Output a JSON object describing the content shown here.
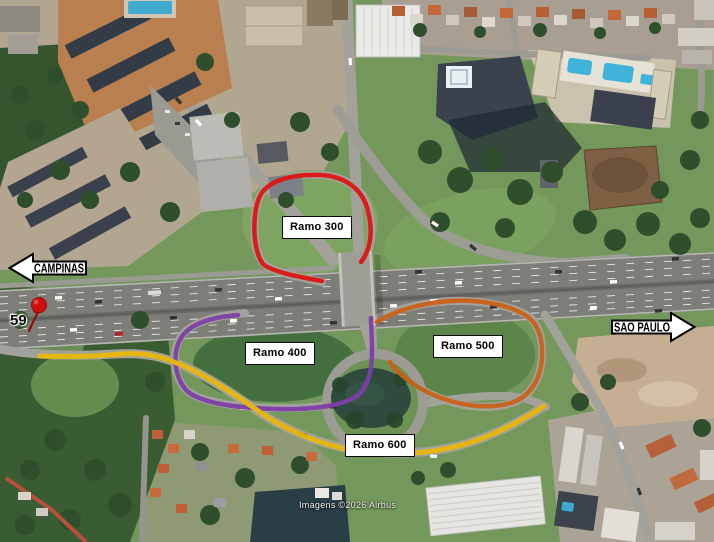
{
  "annotations": {
    "ramps": [
      {
        "id": "300",
        "label": "Ramo 300",
        "color": "#df1414"
      },
      {
        "id": "400",
        "label": "Ramo 400",
        "color": "#7d3fa8"
      },
      {
        "id": "500",
        "label": "Ramo 500",
        "color": "#c8611a"
      },
      {
        "id": "600",
        "label": "Ramo 600",
        "color": "#e9b808"
      }
    ],
    "directions": [
      {
        "id": "campinas",
        "label": "CAMPINAS",
        "arrow": "left"
      },
      {
        "id": "sao-paulo",
        "label": "SÃO PAULO",
        "arrow": "right"
      }
    ],
    "km_marker": {
      "label": "59",
      "pin_color": "#d01010"
    }
  },
  "attribution": {
    "text": "Imagens ©2026 Airbus"
  }
}
